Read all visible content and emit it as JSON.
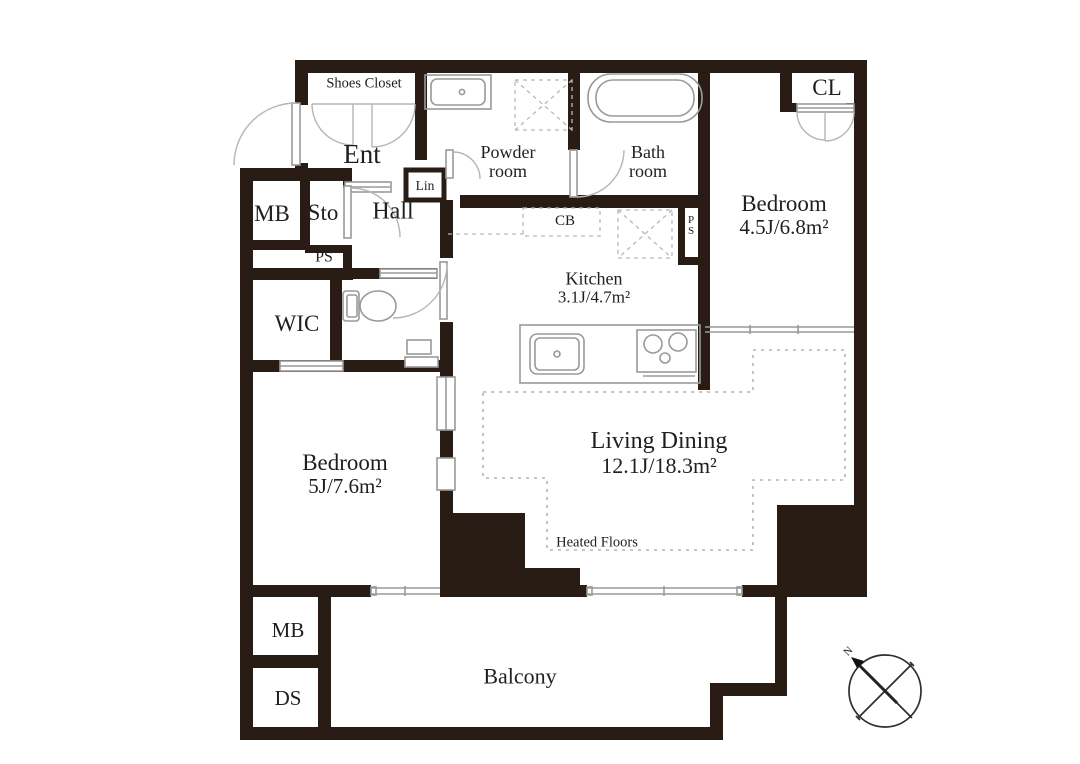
{
  "colors": {
    "wall": "#281c15",
    "fixture_line": "#9a9a9a",
    "door_arc": "#b5b5b5",
    "dashed_line": "#b8b8b8",
    "text": "#1f1f1f",
    "background": "#ffffff"
  },
  "rooms": {
    "shoes_closet": {
      "label": "Shoes Closet"
    },
    "entrance": {
      "label": "Ent"
    },
    "powder_room": {
      "line1": "Powder",
      "line2": "room"
    },
    "bath_room": {
      "line1": "Bath",
      "line2": "room"
    },
    "closet": {
      "label": "CL"
    },
    "bedroom_45": {
      "name": "Bedroom",
      "area": "4.5J/6.8m²"
    },
    "meter_box_upper": {
      "label": "MB"
    },
    "storage": {
      "label": "Sto"
    },
    "hall": {
      "label": "Hall"
    },
    "pipe_space_hall": {
      "label": "PS"
    },
    "linen_closet": {
      "label": "Lin"
    },
    "cupboard": {
      "label": "CB"
    },
    "kitchen": {
      "name": "Kitchen",
      "area": "3.1J/4.7m²"
    },
    "pipe_space_kitchen": {
      "line1": "P",
      "line2": "S"
    },
    "walk_in_closet": {
      "label": "WIC"
    },
    "bedroom_5": {
      "name": "Bedroom",
      "area": "5J/7.6m²"
    },
    "living_dining": {
      "name": "Living Dining",
      "area": "12.1J/18.3m²"
    },
    "heated_floors": {
      "label": "Heated Floors"
    },
    "meter_box_lower": {
      "label": "MB"
    },
    "duct_space": {
      "label": "DS"
    },
    "balcony": {
      "label": "Balcony"
    }
  },
  "compass": {
    "north_label": "N"
  }
}
